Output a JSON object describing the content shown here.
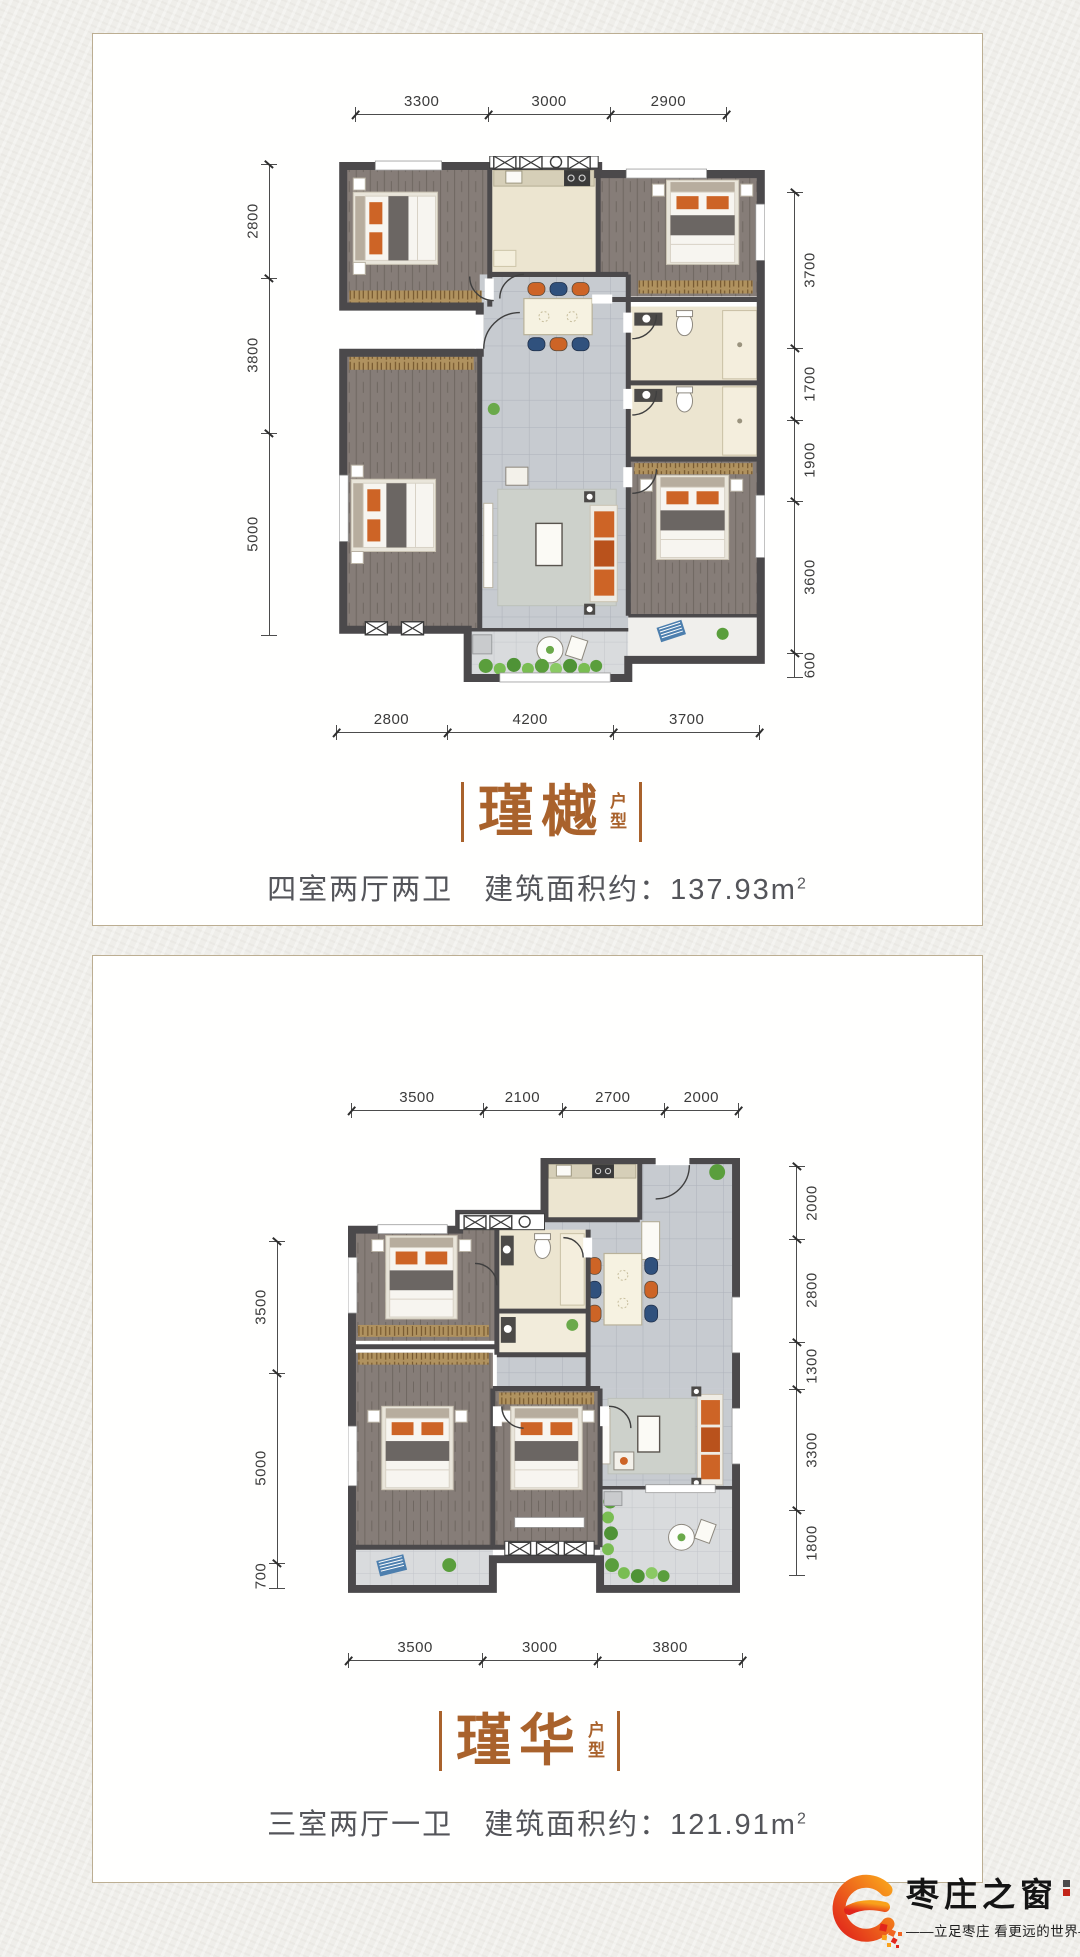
{
  "page": {
    "background": "#efeeea",
    "card_border": "#bcae92",
    "accent_color": "#a9622c"
  },
  "cards": [
    {
      "title": "瑾樾",
      "suffix_top": "户",
      "suffix_bottom": "型",
      "subtitle": "四室两厅两卫　建筑面积约：137.93m",
      "subtitle_sup": "2",
      "dims": {
        "top": [
          "3300",
          "3000",
          "2900"
        ],
        "left": [
          "2800",
          "3800",
          "5000"
        ],
        "right": [
          "3700",
          "1700",
          "1900",
          "3600",
          "600"
        ],
        "bottom": [
          "2800",
          "4200",
          "3700"
        ]
      }
    },
    {
      "title": "瑾华",
      "suffix_top": "户",
      "suffix_bottom": "型",
      "subtitle": "三室两厅一卫　建筑面积约：121.91m",
      "subtitle_sup": "2",
      "dims": {
        "top": [
          "3500",
          "2100",
          "2700",
          "2000"
        ],
        "left": [
          "3500",
          "5000",
          "700"
        ],
        "right": [
          "2000",
          "2800",
          "1300",
          "3300",
          "1800"
        ],
        "bottom": [
          "3500",
          "3000",
          "3800"
        ]
      }
    }
  ],
  "brand": {
    "name": "枣庄之窗",
    "tagline": "——立足枣庄  看更远的世界——",
    "logo_color_start": "#f9a11b",
    "logo_color_end": "#e1251b"
  }
}
